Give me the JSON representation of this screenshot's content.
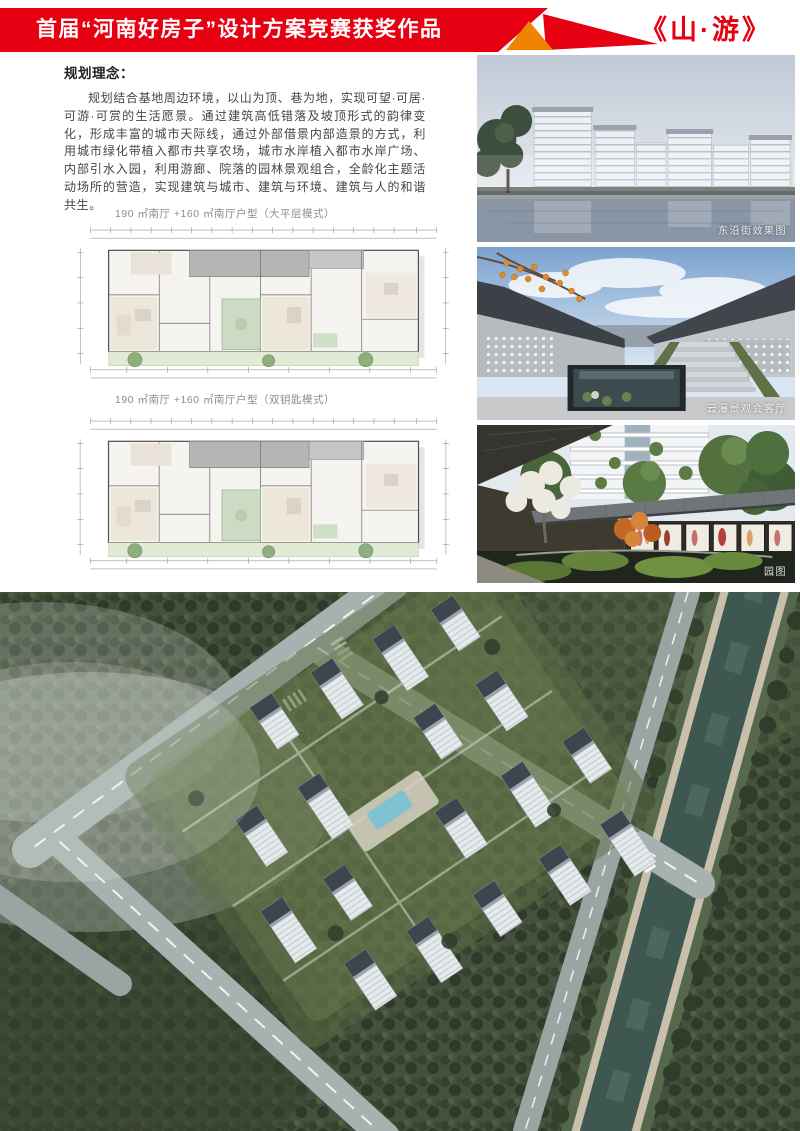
{
  "header": {
    "banner_text": "首届“河南好房子”设计方案竞赛获奖作品",
    "work_title": "《山·游》"
  },
  "concept": {
    "heading": "规划理念：",
    "body": "规划结合基地周边环境，以山为顶、巷为地，实现可望·可居·可游·可赏的生活愿景。通过建筑高低错落及坡顶形式的韵律变化，形成丰富的城市天际线，通过外部借景内部造景的方式，利用城市绿化带植入都市共享农场，城市水岸植入都市水岸广场、内部引水入园，利用游廊、院落的园林景观组合，全龄化主题活动场所的营造，实现建筑与城市、建筑与环境、建筑与人的和谐共生。"
  },
  "floor_plans": [
    {
      "caption": "190 ㎡南厅 +160 ㎡南厅户型（大平层模式）"
    },
    {
      "caption": "190 ㎡南厅 +160 ㎡南厅户型（双钥匙模式）"
    }
  ],
  "renderings": [
    {
      "caption": "东沿街效果图"
    },
    {
      "caption": "云瀑景观会客厅"
    },
    {
      "caption": "园图"
    }
  ],
  "colors": {
    "banner_red": "#e60012",
    "accent_orange": "#f08300",
    "title_red": "#e60012",
    "body_text": "#454545",
    "caption_gray": "#8c8c8c"
  }
}
